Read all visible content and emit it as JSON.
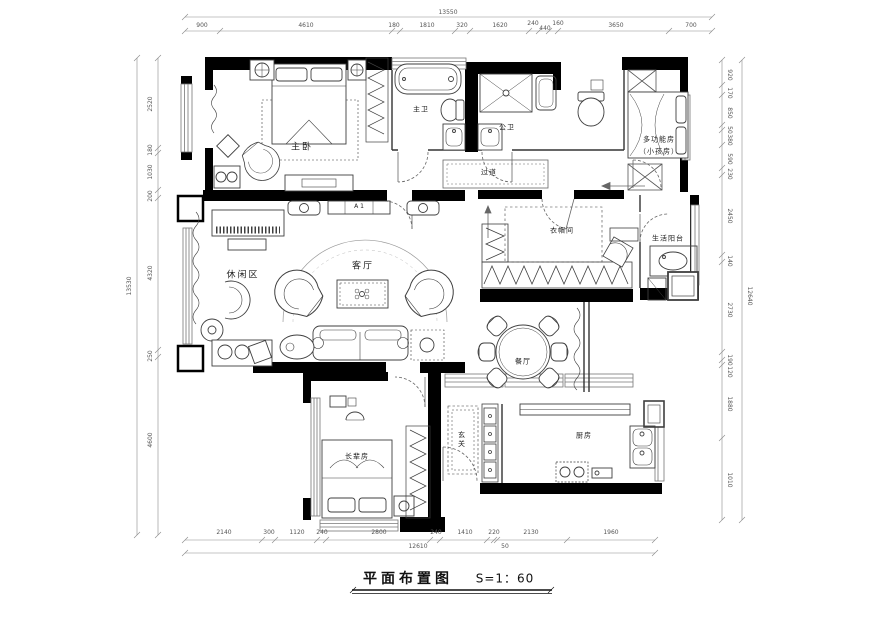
{
  "meta": {
    "title": "平面布置图",
    "scale": "S=1：60"
  },
  "rooms": {
    "master_bedroom": "主卧",
    "master_bath": "主卫",
    "public_bath": "公卫",
    "multi_room": "多功能房",
    "multi_room_sub": "（小孩房）",
    "corridor": "过道",
    "leisure": "休闲区",
    "living": "客厅",
    "tv_label": "A 1",
    "cloakroom": "衣帽间",
    "balcony": "生活阳台",
    "dining": "餐厅",
    "elder_room": "长辈房",
    "foyer": "玄关",
    "kitchen": "厨房"
  },
  "dims": {
    "top": {
      "total": "13550",
      "segments": [
        "900",
        "4610",
        "180",
        "1810",
        "320",
        "1620",
        "240",
        "440",
        "160",
        "3650",
        "700"
      ]
    },
    "bottom": {
      "total": "12610",
      "segments": [
        "2140",
        "300",
        "1120",
        "240",
        "2800",
        "240",
        "1410",
        "220",
        "50",
        "2130",
        "1960"
      ]
    },
    "left": {
      "total": "13530",
      "segments": [
        "2520",
        "180",
        "1030",
        "200",
        "4320",
        "250",
        "4600"
      ]
    },
    "right": {
      "total": "12640",
      "segments": [
        "920",
        "170",
        "850",
        "50",
        "380",
        "590",
        "230",
        "2450",
        "140",
        "2730",
        "190",
        "120",
        "1880",
        "1010"
      ]
    }
  },
  "colors": {
    "wall": "#000000",
    "furniture": "#3f3f3f",
    "dimline": "#8a8a8a",
    "background": "#ffffff"
  }
}
